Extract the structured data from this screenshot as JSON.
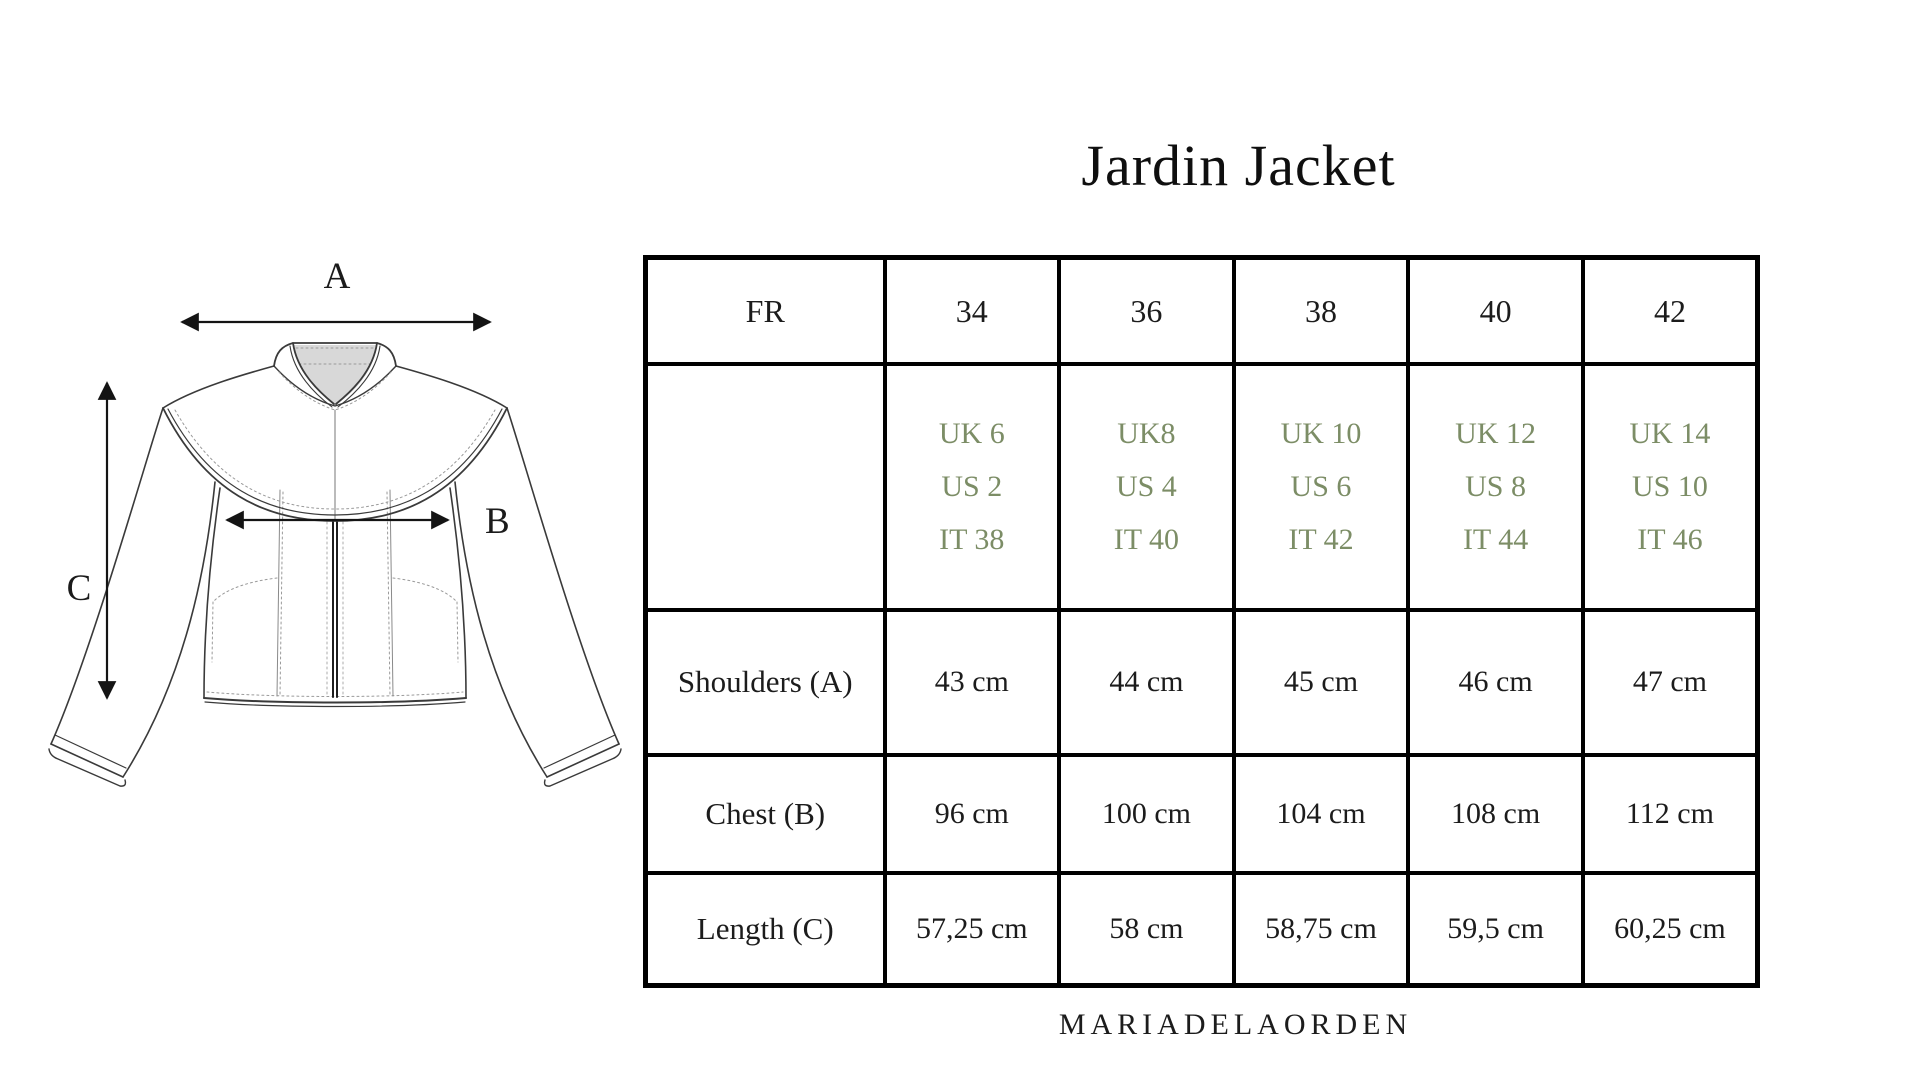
{
  "title": "Jardin Jacket",
  "brand_footer": "MARIADELAORDEN",
  "diagram": {
    "measure_labels": {
      "shoulders": "A",
      "chest": "B",
      "length": "C"
    }
  },
  "size_table": {
    "header": {
      "region_label": "FR",
      "sizes": [
        "34",
        "36",
        "38",
        "40",
        "42"
      ]
    },
    "conversions": [
      {
        "uk": "UK 6",
        "us": "US 2",
        "it": "IT 38"
      },
      {
        "uk": "UK8",
        "us": "US 4",
        "it": "IT 40"
      },
      {
        "uk": "UK 10",
        "us": "US 6",
        "it": "IT 42"
      },
      {
        "uk": "UK 12",
        "us": "US 8",
        "it": "IT 44"
      },
      {
        "uk": "UK 14",
        "us": "US 10",
        "it": "IT 46"
      }
    ],
    "measurements": [
      {
        "label": "Shoulders (A)",
        "values": [
          "43 cm",
          "44 cm",
          "45 cm",
          "46 cm",
          "47 cm"
        ]
      },
      {
        "label": "Chest (B)",
        "values": [
          "96 cm",
          "100 cm",
          "104 cm",
          "108 cm",
          "112 cm"
        ]
      },
      {
        "label": "Length (C)",
        "values": [
          "57,25 cm",
          "58 cm",
          "58,75 cm",
          "59,5 cm",
          "60,25 cm"
        ]
      }
    ]
  },
  "colors": {
    "accent_green": "#7c8d66",
    "text": "#1a1a1a",
    "table_border": "#000000",
    "collar_fill": "#d8d8d8",
    "line_art": "#3a3a3a"
  }
}
